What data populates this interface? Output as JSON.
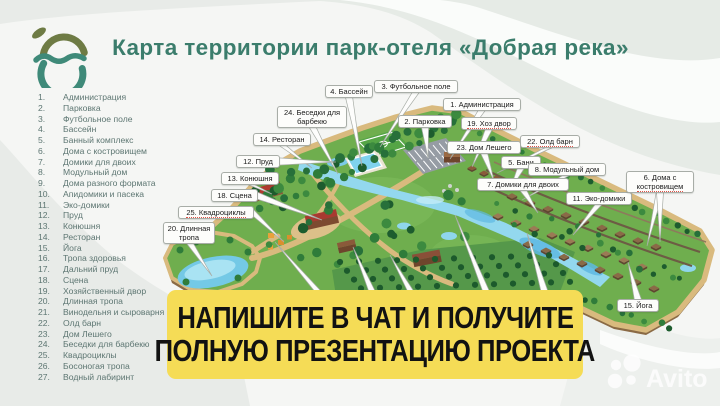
{
  "header": {
    "title": "Карта территории парк-отеля «Добрая река»",
    "logo": "dobraya-reka-logo"
  },
  "legend": {
    "items": [
      {
        "num": "1.",
        "label": "Администрация"
      },
      {
        "num": "2.",
        "label": "Парковка"
      },
      {
        "num": "3.",
        "label": "Футбольное поле"
      },
      {
        "num": "4.",
        "label": "Бассейн"
      },
      {
        "num": "5.",
        "label": "Банный комплекс"
      },
      {
        "num": "6.",
        "label": "Дома с костровищем"
      },
      {
        "num": "7.",
        "label": "Домики для двоих"
      },
      {
        "num": "8.",
        "label": "Модульный дом"
      },
      {
        "num": "9.",
        "label": "Дома разного формата"
      },
      {
        "num": "10.",
        "label": "Апидомики и пасека"
      },
      {
        "num": "11.",
        "label": "Эко-домики"
      },
      {
        "num": "12.",
        "label": "Пруд"
      },
      {
        "num": "13.",
        "label": "Конюшня"
      },
      {
        "num": "14.",
        "label": "Ресторан"
      },
      {
        "num": "15.",
        "label": "Йога"
      },
      {
        "num": "16.",
        "label": "Тропа здоровья"
      },
      {
        "num": "17.",
        "label": "Дальний пруд"
      },
      {
        "num": "18.",
        "label": "Сцена"
      },
      {
        "num": "19.",
        "label": "Хозяйственный двор"
      },
      {
        "num": "20.",
        "label": "Длинная тропа"
      },
      {
        "num": "21.",
        "label": "Винодельня и сыроварня"
      },
      {
        "num": "22.",
        "label": "Олд барн"
      },
      {
        "num": "23.",
        "label": "Дом Лешего"
      },
      {
        "num": "24.",
        "label": "Беседки для барбекю"
      },
      {
        "num": "25.",
        "label": "Квадроциклы"
      },
      {
        "num": "26.",
        "label": "Босоногая тропа"
      },
      {
        "num": "27.",
        "label": "Водный лабиринт"
      }
    ]
  },
  "map": {
    "callouts": [
      {
        "x": 325,
        "y": 85,
        "w": 48,
        "lines": [
          {
            "t": "4. Бассейн",
            "ul": 0
          }
        ],
        "targets": [
          [
            362,
            166
          ]
        ]
      },
      {
        "x": 374,
        "y": 80,
        "w": 84,
        "lines": [
          {
            "t": "3. Футбольное поле",
            "ul": 0
          }
        ],
        "targets": [
          [
            380,
            147
          ]
        ]
      },
      {
        "x": 443,
        "y": 98,
        "w": 78,
        "lines": [
          {
            "t": "1. Администрация",
            "ul": 0
          }
        ],
        "targets": [
          [
            450,
            159
          ]
        ]
      },
      {
        "x": 277,
        "y": 106,
        "w": 70,
        "lines": [
          {
            "t": "24. Беседки для",
            "ul": 0
          },
          {
            "t": "барбекю",
            "ul": 0
          }
        ],
        "targets": [
          [
            338,
            174
          ]
        ]
      },
      {
        "x": 398,
        "y": 115,
        "w": 54,
        "lines": [
          {
            "t": "2. Парковка",
            "ul": 0
          }
        ],
        "targets": [
          [
            428,
            158
          ]
        ]
      },
      {
        "x": 461,
        "y": 117,
        "w": 56,
        "lines": [
          {
            "t": "19. Хоз двор",
            "ul": 1
          }
        ],
        "targets": [
          [
            472,
            167
          ]
        ]
      },
      {
        "x": 520,
        "y": 135,
        "w": 60,
        "lines": [
          {
            "t": "22. Олд барн",
            "ul": 1
          }
        ],
        "targets": [
          [
            497,
            173
          ]
        ]
      },
      {
        "x": 447,
        "y": 141,
        "w": 74,
        "lines": [
          {
            "t": "23. Дом Лешего",
            "ul": 0
          }
        ],
        "targets": [
          [
            494,
            181
          ]
        ]
      },
      {
        "x": 501,
        "y": 156,
        "w": 40,
        "lines": [
          {
            "t": "5. Бани",
            "ul": 0
          }
        ],
        "targets": [
          [
            510,
            190
          ]
        ]
      },
      {
        "x": 528,
        "y": 163,
        "w": 78,
        "lines": [
          {
            "t": "8. Модульный дом",
            "ul": 0
          }
        ],
        "targets": [
          [
            522,
            200
          ]
        ]
      },
      {
        "x": 477,
        "y": 178,
        "w": 92,
        "lines": [
          {
            "t": "7. Домики для двоих",
            "ul": 0
          }
        ],
        "targets": [
          [
            538,
            213
          ]
        ]
      },
      {
        "x": 566,
        "y": 192,
        "w": 66,
        "lines": [
          {
            "t": "11. Эко-домики",
            "ul": 0
          }
        ],
        "targets": [
          [
            573,
            235
          ]
        ]
      },
      {
        "x": 626,
        "y": 171,
        "w": 68,
        "lines": [
          {
            "t": "6. Дома с",
            "ul": 0
          },
          {
            "t": "костровищем",
            "ul": 1
          }
        ],
        "targets": [
          [
            647,
            246
          ],
          [
            660,
            242
          ]
        ]
      },
      {
        "x": 253,
        "y": 133,
        "w": 58,
        "lines": [
          {
            "t": "14. Ресторан",
            "ul": 0
          }
        ],
        "targets": [
          [
            312,
            168
          ]
        ]
      },
      {
        "x": 236,
        "y": 155,
        "w": 44,
        "lines": [
          {
            "t": "12. Пруд",
            "ul": 0
          }
        ],
        "targets": [
          [
            336,
            162
          ]
        ]
      },
      {
        "x": 221,
        "y": 172,
        "w": 58,
        "lines": [
          {
            "t": "13. Конюшня",
            "ul": 0
          }
        ],
        "targets": [
          [
            272,
            194
          ]
        ]
      },
      {
        "x": 211,
        "y": 189,
        "w": 47,
        "lines": [
          {
            "t": "18. Сцена",
            "ul": 0
          }
        ],
        "targets": [
          [
            322,
            220
          ]
        ]
      },
      {
        "x": 178,
        "y": 206,
        "w": 76,
        "lines": [
          {
            "t": "25. Квадроциклы",
            "ul": 1
          }
        ],
        "targets": [
          [
            284,
            242
          ]
        ]
      },
      {
        "x": 163,
        "y": 222,
        "w": 52,
        "lines": [
          {
            "t": "20. Длинная",
            "ul": 0
          },
          {
            "t": "тропа",
            "ul": 0
          }
        ],
        "targets": [
          [
            212,
            276
          ]
        ]
      },
      {
        "x": 617,
        "y": 299,
        "w": 42,
        "lines": [
          {
            "t": "15. Йога",
            "ul": 0
          }
        ],
        "targets": [
          [
            628,
            262
          ]
        ]
      }
    ]
  },
  "banner": {
    "line1": "НАПИШИТЕ В ЧАТ И ПОЛУЧИТЕ",
    "line2": "ПОЛНУЮ ПРЕЗЕНТАЦИЮ ПРОЕКТА"
  },
  "watermark": {
    "text": "Avito"
  },
  "colors": {
    "title": "#3b7d6c",
    "banner_bg": "#f5dc56",
    "banner_text": "#121212",
    "terrain": "#6fae4e",
    "path_tan": "#d9ba7e",
    "water": "#8fd6ec",
    "logo_olive": "#6e7b44",
    "logo_teal": "#3f8a79"
  }
}
